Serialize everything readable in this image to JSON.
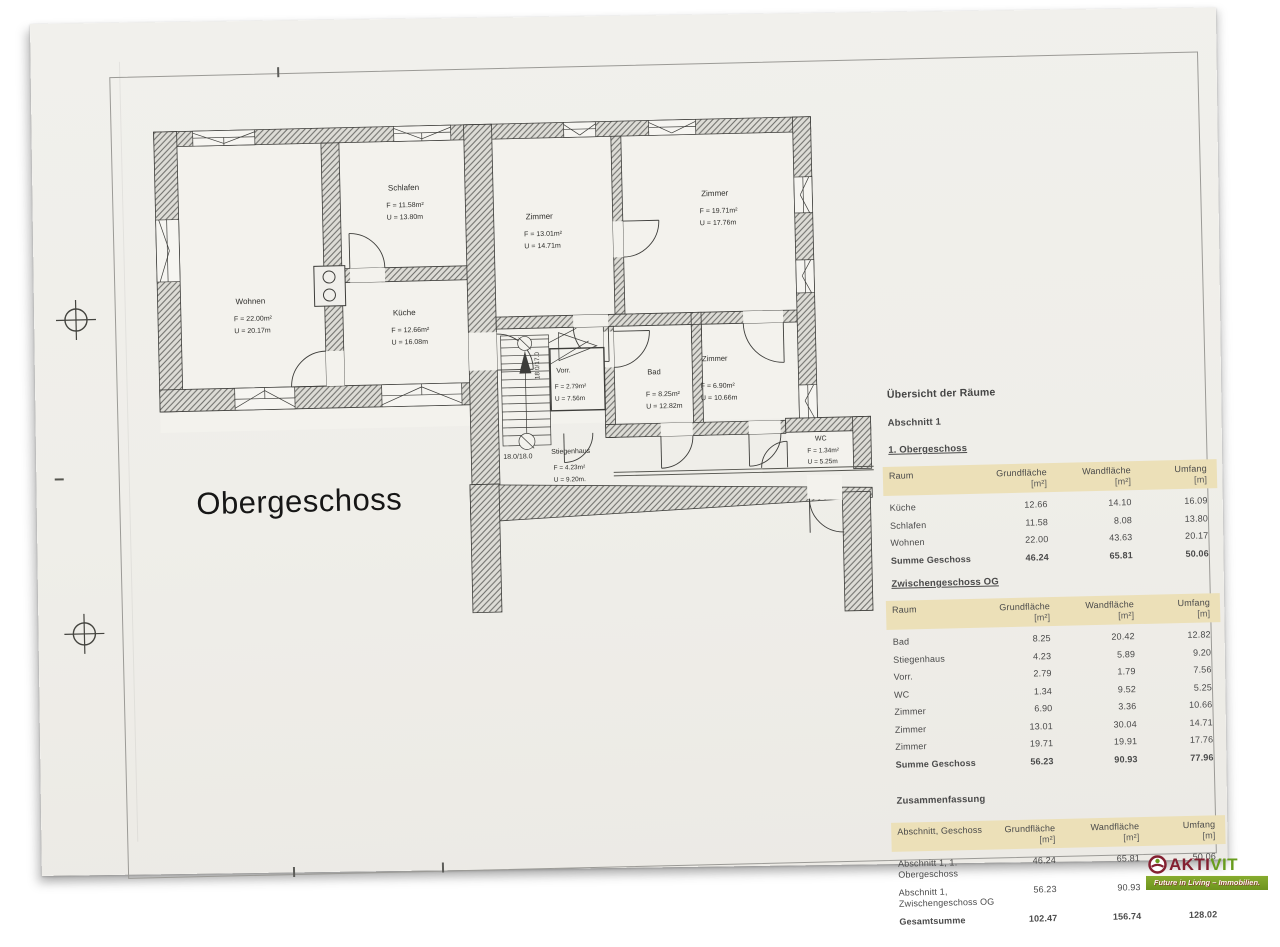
{
  "plan": {
    "title": "Obergeschoss",
    "rooms": {
      "wohnen": {
        "name": "Wohnen",
        "f": "F = 22.00m²",
        "u": "U = 20.17m"
      },
      "schlafen": {
        "name": "Schlafen",
        "f": "F = 11.58m²",
        "u": "U = 13.80m"
      },
      "kueche": {
        "name": "Küche",
        "f": "F = 12.66m²",
        "u": "U = 16.08m"
      },
      "zimmer1": {
        "name": "Zimmer",
        "f": "F = 13.01m²",
        "u": "U = 14.71m"
      },
      "zimmer2": {
        "name": "Zimmer",
        "f": "F = 19.71m²",
        "u": "U = 17.76m"
      },
      "vorraum": {
        "name": "Vorr.",
        "f": "F = 2.79m²",
        "u": "U = 7.56m"
      },
      "bad": {
        "name": "Bad",
        "f": "F = 8.25m²",
        "u": "U = 12.82m"
      },
      "zimmer3": {
        "name": "Zimmer",
        "f": "F = 6.90m²",
        "u": "U = 10.66m"
      },
      "wc": {
        "name": "WC",
        "f": "F = 1.34m²",
        "u": "U = 5.25m"
      },
      "stiegenhaus": {
        "name": "Stiegenhaus",
        "f": "F = 4.23m²",
        "u": "U = 9.20m."
      }
    },
    "stairs": {
      "label_bottom": "18.0/18.0",
      "label_side": "18.0/17.0"
    }
  },
  "tables": {
    "title": "Übersicht der Räume",
    "section": "Abschnitt 1",
    "headers": {
      "raum": "Raum",
      "abschnitt": "Abschnitt, Geschoss",
      "grund": "Grundfläche",
      "wand": "Wandfläche",
      "umfang": "Umfang",
      "unit_m2": "[m²]",
      "unit_m": "[m]"
    },
    "og": {
      "heading": "1. Obergeschoss",
      "rows": [
        [
          "Küche",
          "12.66",
          "14.10",
          "16.09"
        ],
        [
          "Schlafen",
          "11.58",
          "8.08",
          "13.80"
        ],
        [
          "Wohnen",
          "22.00",
          "43.63",
          "20.17"
        ]
      ],
      "sum": [
        "Summe Geschoss",
        "46.24",
        "65.81",
        "50.06"
      ]
    },
    "zg": {
      "heading": "Zwischengeschoss OG",
      "rows": [
        [
          "Bad",
          "8.25",
          "20.42",
          "12.82"
        ],
        [
          "Stiegenhaus",
          "4.23",
          "5.89",
          "9.20"
        ],
        [
          "Vorr.",
          "2.79",
          "1.79",
          "7.56"
        ],
        [
          "WC",
          "1.34",
          "9.52",
          "5.25"
        ],
        [
          "Zimmer",
          "6.90",
          "3.36",
          "10.66"
        ],
        [
          "Zimmer",
          "13.01",
          "30.04",
          "14.71"
        ],
        [
          "Zimmer",
          "19.71",
          "19.91",
          "17.76"
        ]
      ],
      "sum": [
        "Summe Geschoss",
        "56.23",
        "90.93",
        "77.96"
      ]
    },
    "summary": {
      "heading": "Zusammenfassung",
      "rows": [
        [
          "Abschnitt 1, 1. Obergeschoss",
          "46.24",
          "65.81",
          "50.06"
        ],
        [
          "Abschnitt 1, Zwischengeschoss OG",
          "56.23",
          "90.93",
          "77.96"
        ]
      ],
      "sum": [
        "Gesamtsumme",
        "102.47",
        "156.74",
        "128.02"
      ]
    }
  },
  "logo": {
    "brand_left": "AKTI",
    "brand_right": "VIT",
    "tagline": "Future in Living – Immobilien.",
    "color_dark": "#832031",
    "color_green": "#689c1e"
  }
}
